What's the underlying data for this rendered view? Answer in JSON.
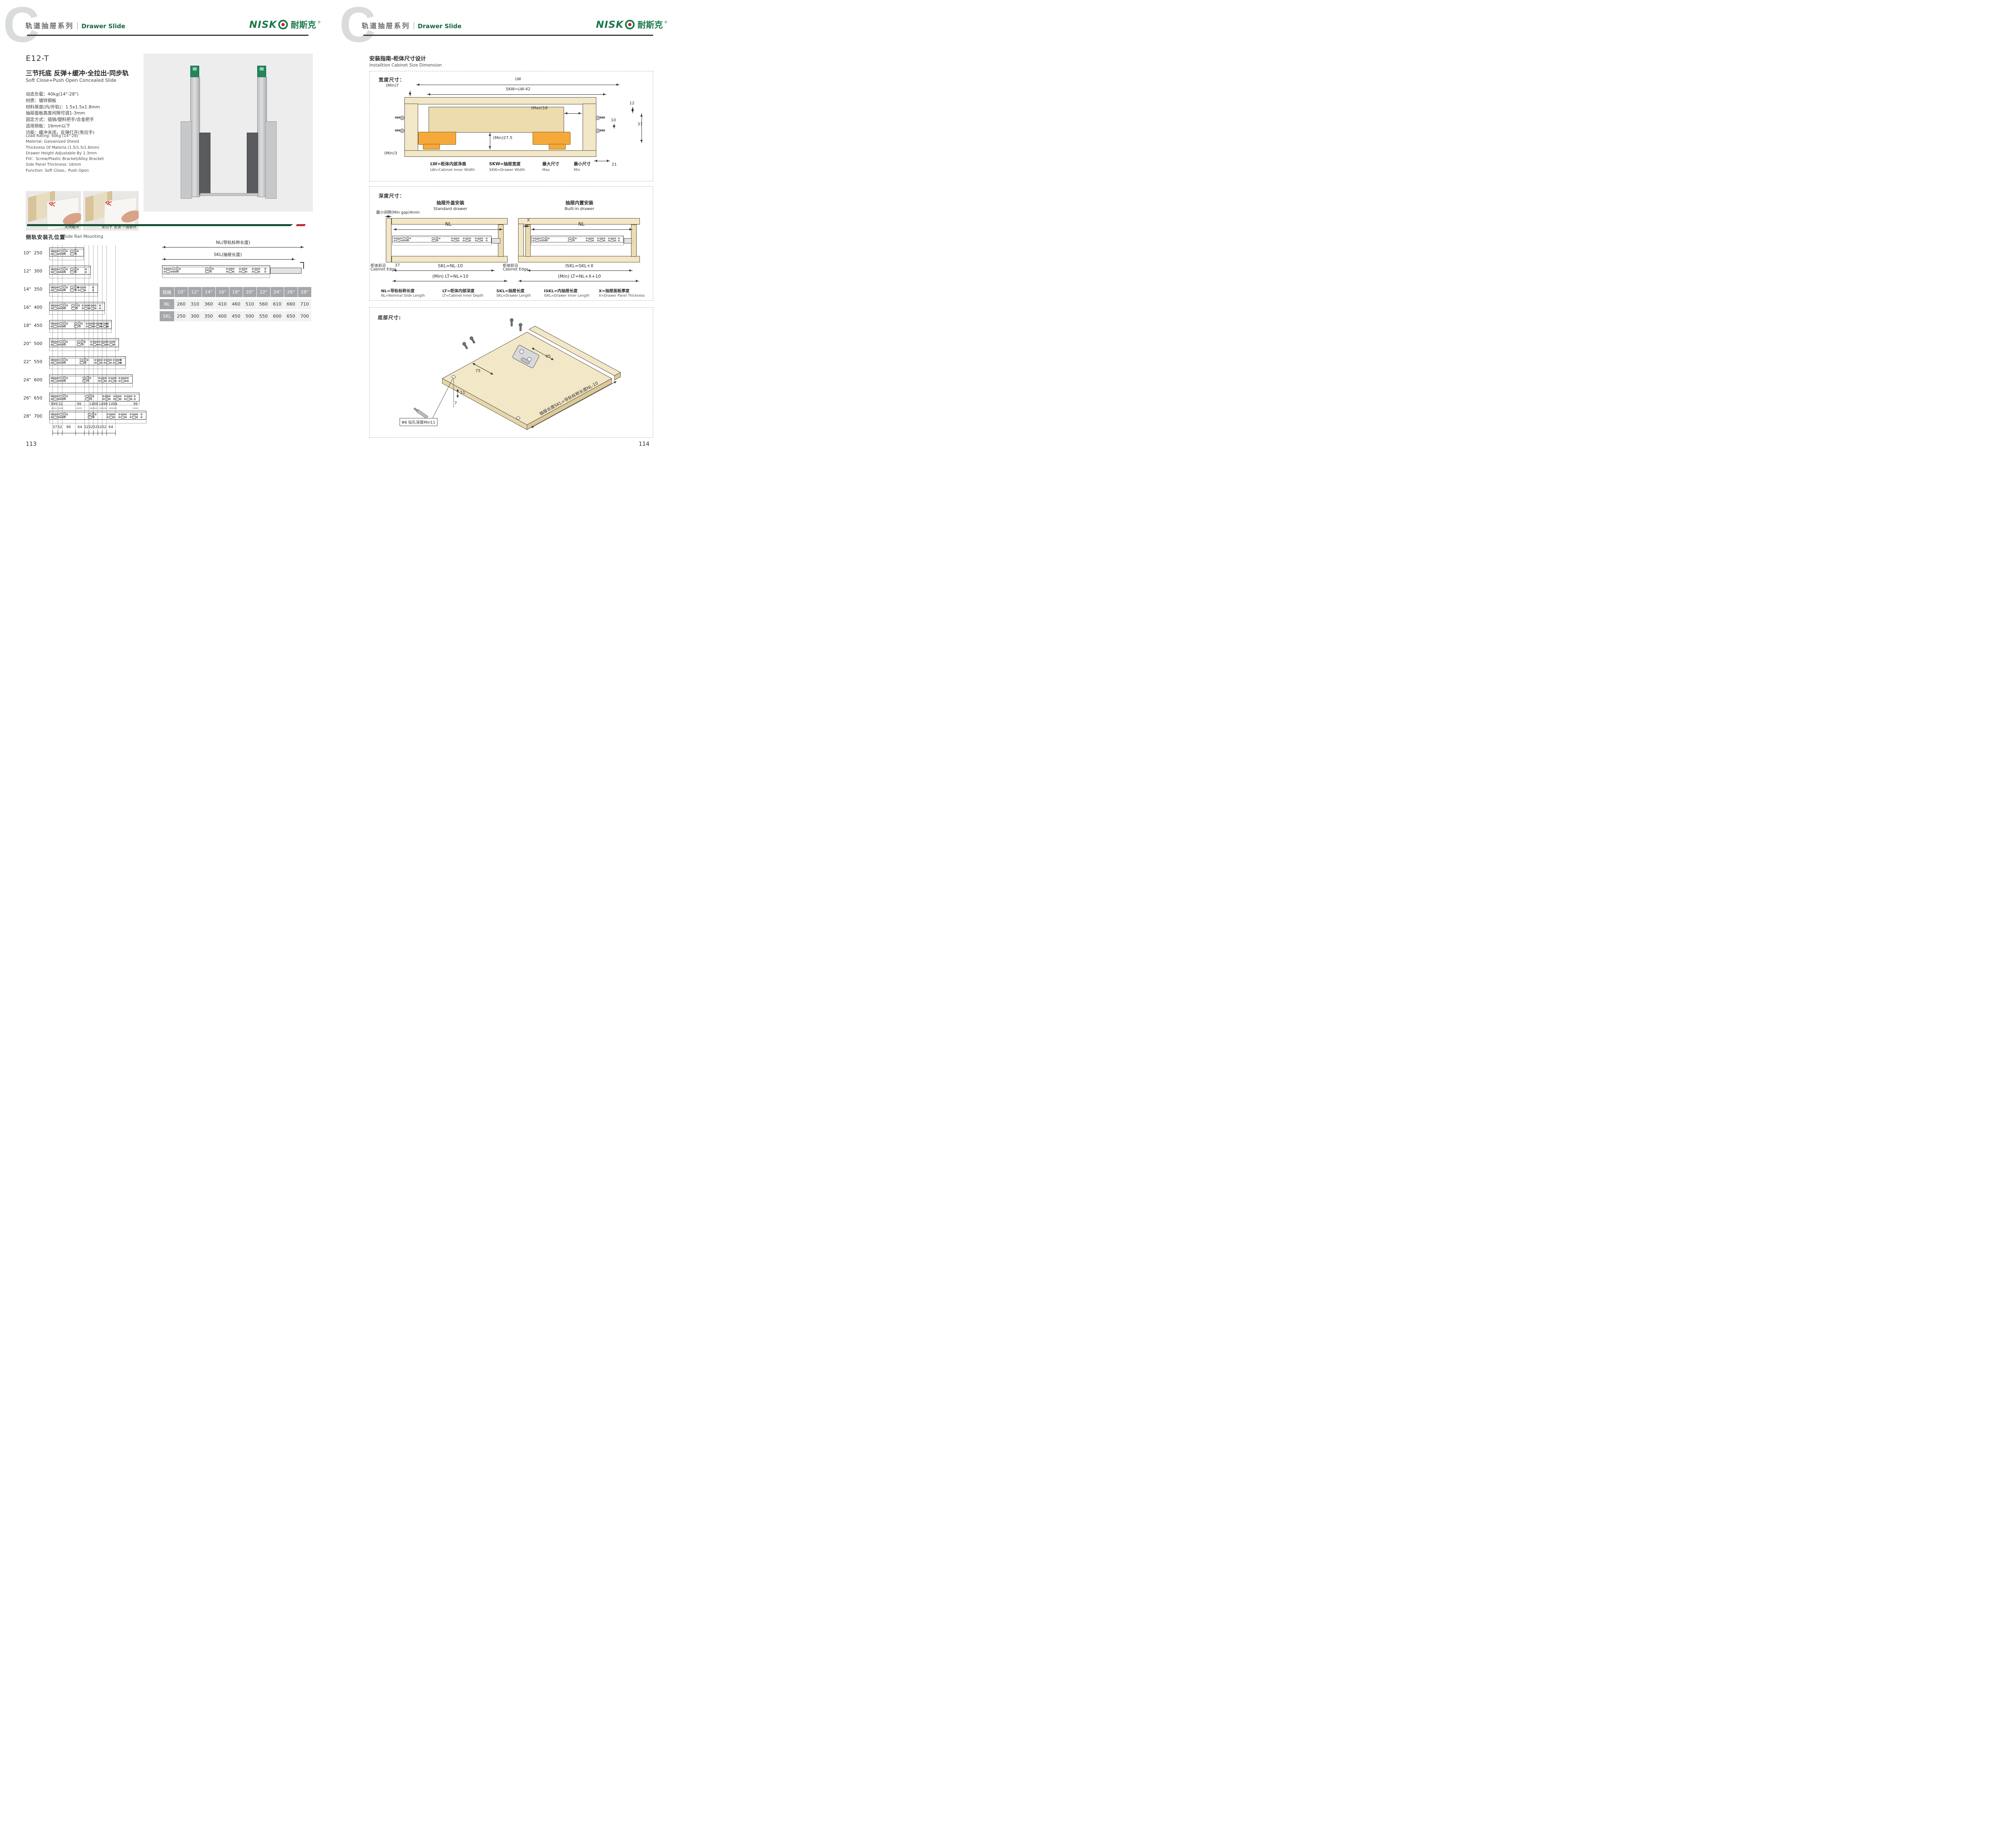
{
  "brand": {
    "logo_lat": "NISK",
    "logo_cn": "耐斯克",
    "reg": "®"
  },
  "header": {
    "watermark": "C",
    "series_cn": "轨道抽屉系列",
    "series_en": "Drawer Slide"
  },
  "left": {
    "model": "E12-T",
    "title_cn": "三节托底 反弹+缓冲·全拉出·同步轨",
    "title_en": "Soft Close+Push Open Concealed Slide",
    "specs_cn": [
      "动态负载：40kg(14\"-28\")",
      "材质：镀锌钢板",
      "材料厚度(内/外轨)：1.5x1.5x1.8mm",
      "抽屉面板高度间隙可调1-3mm",
      "固定方式：插销/塑料把手/合金把手",
      "适用侧板：16mm以下",
      "功能：缓冲关闭，反弹打开(免拉手)"
    ],
    "specs_en": [
      "Load Rating: 40kg (14\"-28)",
      "Material: Galvanized Sheed",
      "Thickness Of Materia (1.5/1.5/1.8mm)",
      "Drawer Height Adjustable By 1-3mm",
      "FIX：Screw/Plastic Bracket/Alloy Bracket",
      "Side Panel Thickness: 16mm",
      "Function: Soft Close，Push Open"
    ],
    "photos": [
      {
        "caption": "关闭缓冲"
      },
      {
        "caption": "免拉手 反弹 一按即开"
      }
    ],
    "section_cn": "侧轨安装孔位置",
    "section_en": "Side Rail Mounting",
    "rails": [
      {
        "inch": "10\"",
        "mm": "250"
      },
      {
        "inch": "12\"",
        "mm": "300"
      },
      {
        "inch": "14\"",
        "mm": "350"
      },
      {
        "inch": "16\"",
        "mm": "400"
      },
      {
        "inch": "18\"",
        "mm": "450"
      },
      {
        "inch": "20\"",
        "mm": "500"
      },
      {
        "inch": "22\"",
        "mm": "550"
      },
      {
        "inch": "24\"",
        "mm": "600"
      },
      {
        "inch": "26\"",
        "mm": "650"
      },
      {
        "inch": "28\"",
        "mm": "700"
      }
    ],
    "top_dims": [
      "999",
      "32",
      "99",
      "1499",
      "1499",
      "1499",
      "99"
    ],
    "bottom_dims": [
      "37",
      "32",
      "96",
      "64",
      "32",
      "32",
      "32",
      "32",
      "32",
      "64"
    ],
    "page": "113"
  },
  "diagram": {
    "nl_label": "NL(导轨标称长度)",
    "skl_label": "SKL(抽屉长度)"
  },
  "table": {
    "spec_header": "规格",
    "sizes": [
      "10\"",
      "12\"",
      "14\"",
      "16\"",
      "18\"",
      "20\"",
      "22\"",
      "24\"",
      "26\"",
      "28\""
    ],
    "nl_label": "NL",
    "nl": [
      "260",
      "310",
      "360",
      "410",
      "460",
      "510",
      "560",
      "610",
      "660",
      "710"
    ],
    "skl_label": "SKL",
    "skl": [
      "250",
      "300",
      "350",
      "400",
      "450",
      "500",
      "550",
      "600",
      "650",
      "700"
    ]
  },
  "right": {
    "guide_cn": "安装指南-柜体尺寸设计",
    "guide_en": "Installtion Cabinet Size Dimension",
    "width": {
      "label": "宽度尺寸：",
      "lw": "LW",
      "skw": "SKW=LW-42",
      "min7": "(Min)7",
      "max16": "(Max)16",
      "d12": "12",
      "d10": "10",
      "d37": "37",
      "min275": "(Min)27.5",
      "min3": "(Min)3",
      "d21": "21",
      "legend": [
        {
          "cn": "LW=柜体内部净高",
          "en": "LW=Cabinet Inner Width"
        },
        {
          "cn": "SKW=抽屉宽度",
          "en": "SKW=Drawer  Width"
        },
        {
          "cn": "最大尺寸",
          "en": "Max"
        },
        {
          "cn": "最小尺寸",
          "en": "Min"
        }
      ]
    },
    "depth": {
      "label": "深度尺寸：",
      "min_gap": "最小间隙(Min gap)4mm",
      "std_cn": "抽屉外盖安装",
      "std_en": "Standard drawer",
      "builtin_cn": "抽屉内置安装",
      "builtin_en": "Built-in drawer",
      "nl": "NL",
      "x": "X",
      "d37": "37",
      "skl": "SKL=NL-10",
      "lt": "(Min) LT=NL+10",
      "iskl": "ISKL=SKL+X",
      "lt2": "(Min) LT=NL+X+10",
      "edge_cn": "柜体前沿",
      "edge_en": "Cabinet Edge",
      "legend": [
        {
          "cn": "NL=导轨标称长度",
          "en": "NL=Nominal Slide Length"
        },
        {
          "cn": "LT=柜体内部深度",
          "en": "LT=Cabinet Inner Depth"
        },
        {
          "cn": "SKL=抽屉长度",
          "en": "SKL=Drawer Length"
        },
        {
          "cn": "ISKL=内抽屉长度",
          "en": "ISKL=Drawer Inner Length"
        },
        {
          "cn": "X=抽屉面板厚度",
          "en": "X=Drawer Panel Thickness"
        }
      ]
    },
    "bottom": {
      "label": "底部尺寸:",
      "d75": "75",
      "d85": "85",
      "d11": "11",
      "d7": "7",
      "drill": "Φ6 钻孔深度Min11",
      "note": "抽屉长度SKL=导轨标称长度NL-10"
    },
    "page": "114"
  }
}
